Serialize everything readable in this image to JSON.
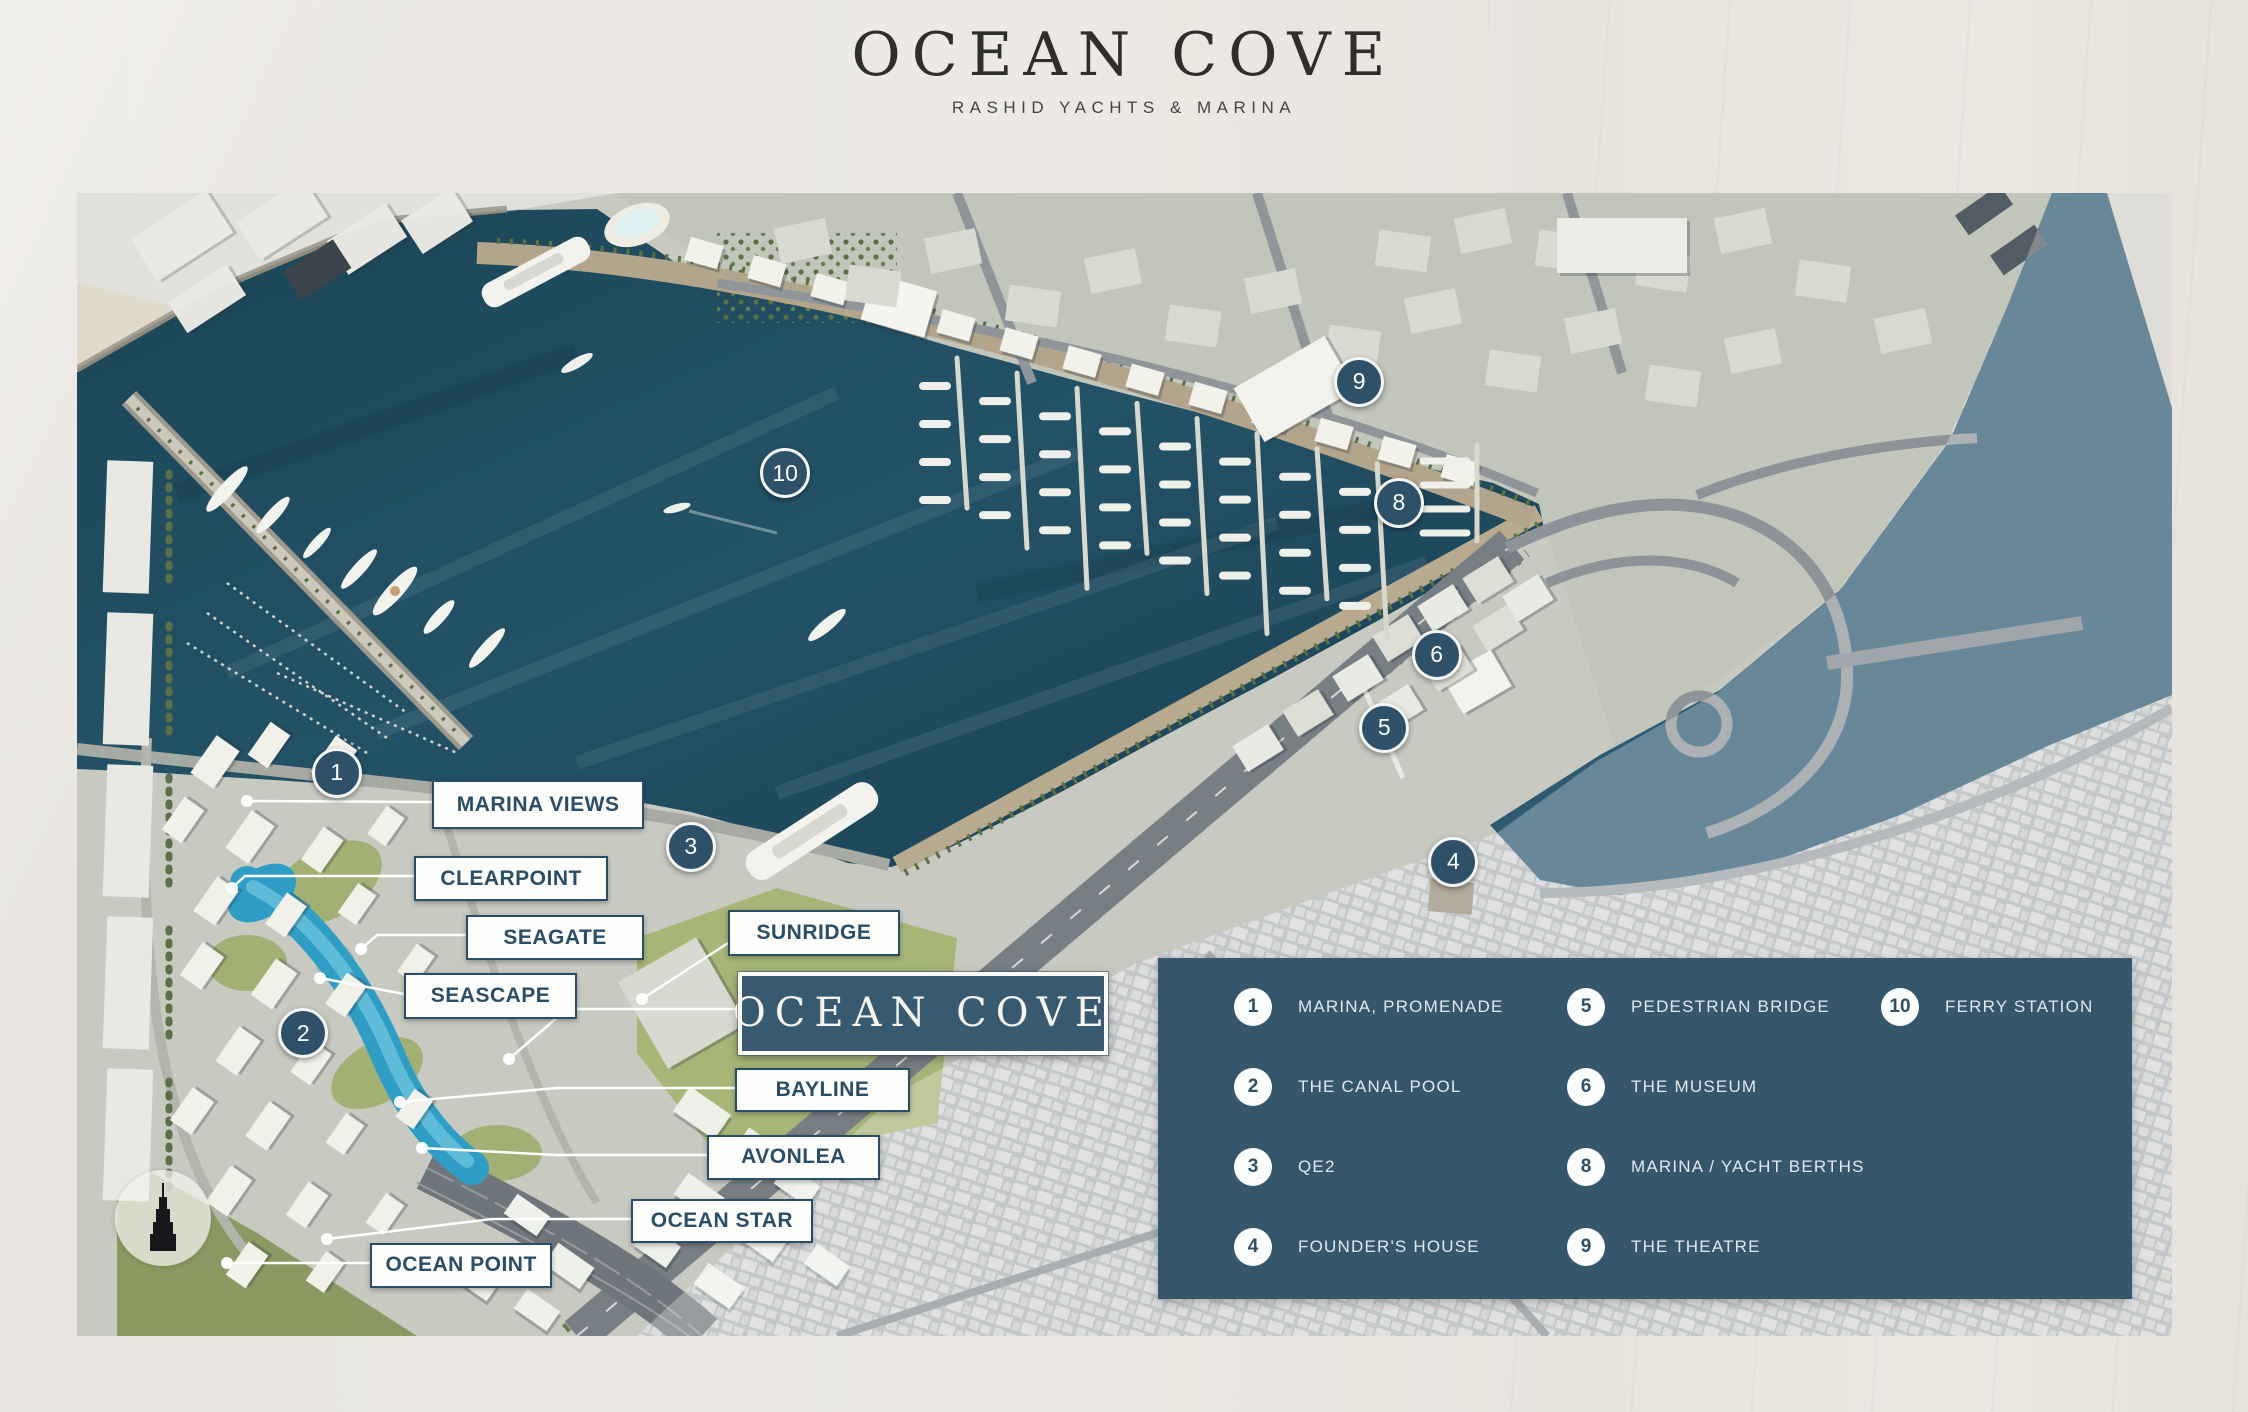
{
  "header": {
    "title": "OCEAN COVE",
    "subtitle": "RASHID YACHTS & MARINA"
  },
  "map": {
    "markers": [
      {
        "number": "1",
        "x": 12.4,
        "y": 50.7
      },
      {
        "number": "2",
        "x": 10.8,
        "y": 73.5
      },
      {
        "number": "3",
        "x": 29.3,
        "y": 57.2
      },
      {
        "number": "4",
        "x": 65.7,
        "y": 58.5
      },
      {
        "number": "5",
        "x": 62.4,
        "y": 46.8
      },
      {
        "number": "6",
        "x": 64.9,
        "y": 40.4
      },
      {
        "number": "8",
        "x": 63.1,
        "y": 27.1
      },
      {
        "number": "9",
        "x": 61.2,
        "y": 16.5
      },
      {
        "number": "10",
        "x": 33.8,
        "y": 24.5
      }
    ],
    "property_labels": [
      {
        "text": "MARINA VIEWS",
        "left": 16.95,
        "top": 51.36,
        "width": 9.93,
        "height": 3.94,
        "leader": [
          [
            355,
            609
          ],
          [
            170,
            608
          ]
        ]
      },
      {
        "text": "CLEARPOINT",
        "left": 16.09,
        "top": 58.01,
        "width": 9.07,
        "height": 3.59,
        "leader": [
          [
            337,
            683
          ],
          [
            168,
            683
          ],
          [
            155,
            695
          ]
        ]
      },
      {
        "text": "SEAGATE",
        "left": 18.57,
        "top": 63.17,
        "width": 8.31,
        "height": 3.59,
        "leader": [
          [
            389,
            742
          ],
          [
            300,
            742
          ],
          [
            284,
            756
          ]
        ]
      },
      {
        "text": "SUNRIDGE",
        "left": 31.07,
        "top": 62.73,
        "width": 8.02,
        "height": 3.67,
        "leader": [
          [
            651,
            750
          ],
          [
            565,
            806
          ]
        ]
      },
      {
        "text": "SEASCAPE",
        "left": 15.61,
        "top": 68.24,
        "width": 8.07,
        "height": 3.67,
        "leader": [
          [
            327,
            801
          ],
          [
            243,
            785
          ]
        ]
      },
      {
        "text": "BAYLINE",
        "left": 31.41,
        "top": 76.55,
        "width": 8.16,
        "height": 3.5,
        "leader": [
          [
            658,
            895
          ],
          [
            480,
            895
          ],
          [
            323,
            909
          ]
        ]
      },
      {
        "text": "AVONLEA",
        "left": 30.07,
        "top": 82.41,
        "width": 8.07,
        "height": 3.59,
        "leader": [
          [
            630,
            962
          ],
          [
            480,
            962
          ],
          [
            345,
            955
          ]
        ]
      },
      {
        "text": "OCEAN STAR",
        "left": 26.44,
        "top": 88.01,
        "width": 8.5,
        "height": 3.5,
        "leader": [
          [
            554,
            1026
          ],
          [
            415,
            1026
          ],
          [
            250,
            1046
          ]
        ]
      },
      {
        "text": "OCEAN POINT",
        "left": 13.99,
        "top": 91.86,
        "width": 8.5,
        "height": 3.59,
        "leader": [
          [
            293,
            1070
          ],
          [
            150,
            1070
          ]
        ]
      }
    ],
    "project_label": {
      "text": "OCEAN COVE",
      "left": 31.55,
      "top": 68.15,
      "width": 17.28,
      "height": 6.56,
      "leader": [
        [
          661,
          816
        ],
        [
          490,
          816
        ],
        [
          432,
          866
        ]
      ]
    },
    "landmark": {
      "icon": "burj-khalifa-icon",
      "x": 4.1,
      "y": 89.7
    }
  },
  "legend": {
    "columns": [
      {
        "items": [
          {
            "number": "1",
            "label": "MARINA, PROMENADE"
          },
          {
            "number": "2",
            "label": "THE CANAL POOL"
          },
          {
            "number": "3",
            "label": "QE2"
          },
          {
            "number": "4",
            "label": "FOUNDER'S HOUSE"
          }
        ]
      },
      {
        "items": [
          {
            "number": "5",
            "label": "PEDESTRIAN BRIDGE"
          },
          {
            "number": "6",
            "label": "THE MUSEUM"
          },
          {
            "number": "8",
            "label": "MARINA / YACHT BERTHS"
          },
          {
            "number": "9",
            "label": "THE THEATRE"
          }
        ]
      },
      {
        "items": [
          {
            "number": "10",
            "label": "FERRY STATION"
          }
        ]
      }
    ]
  },
  "colors": {
    "accent_blue": "#35566b",
    "label_text": "#2b4e68",
    "water": "#1d4a5c",
    "pool_blue": "#2f9ec6",
    "page_background": "#e9e6e1"
  }
}
